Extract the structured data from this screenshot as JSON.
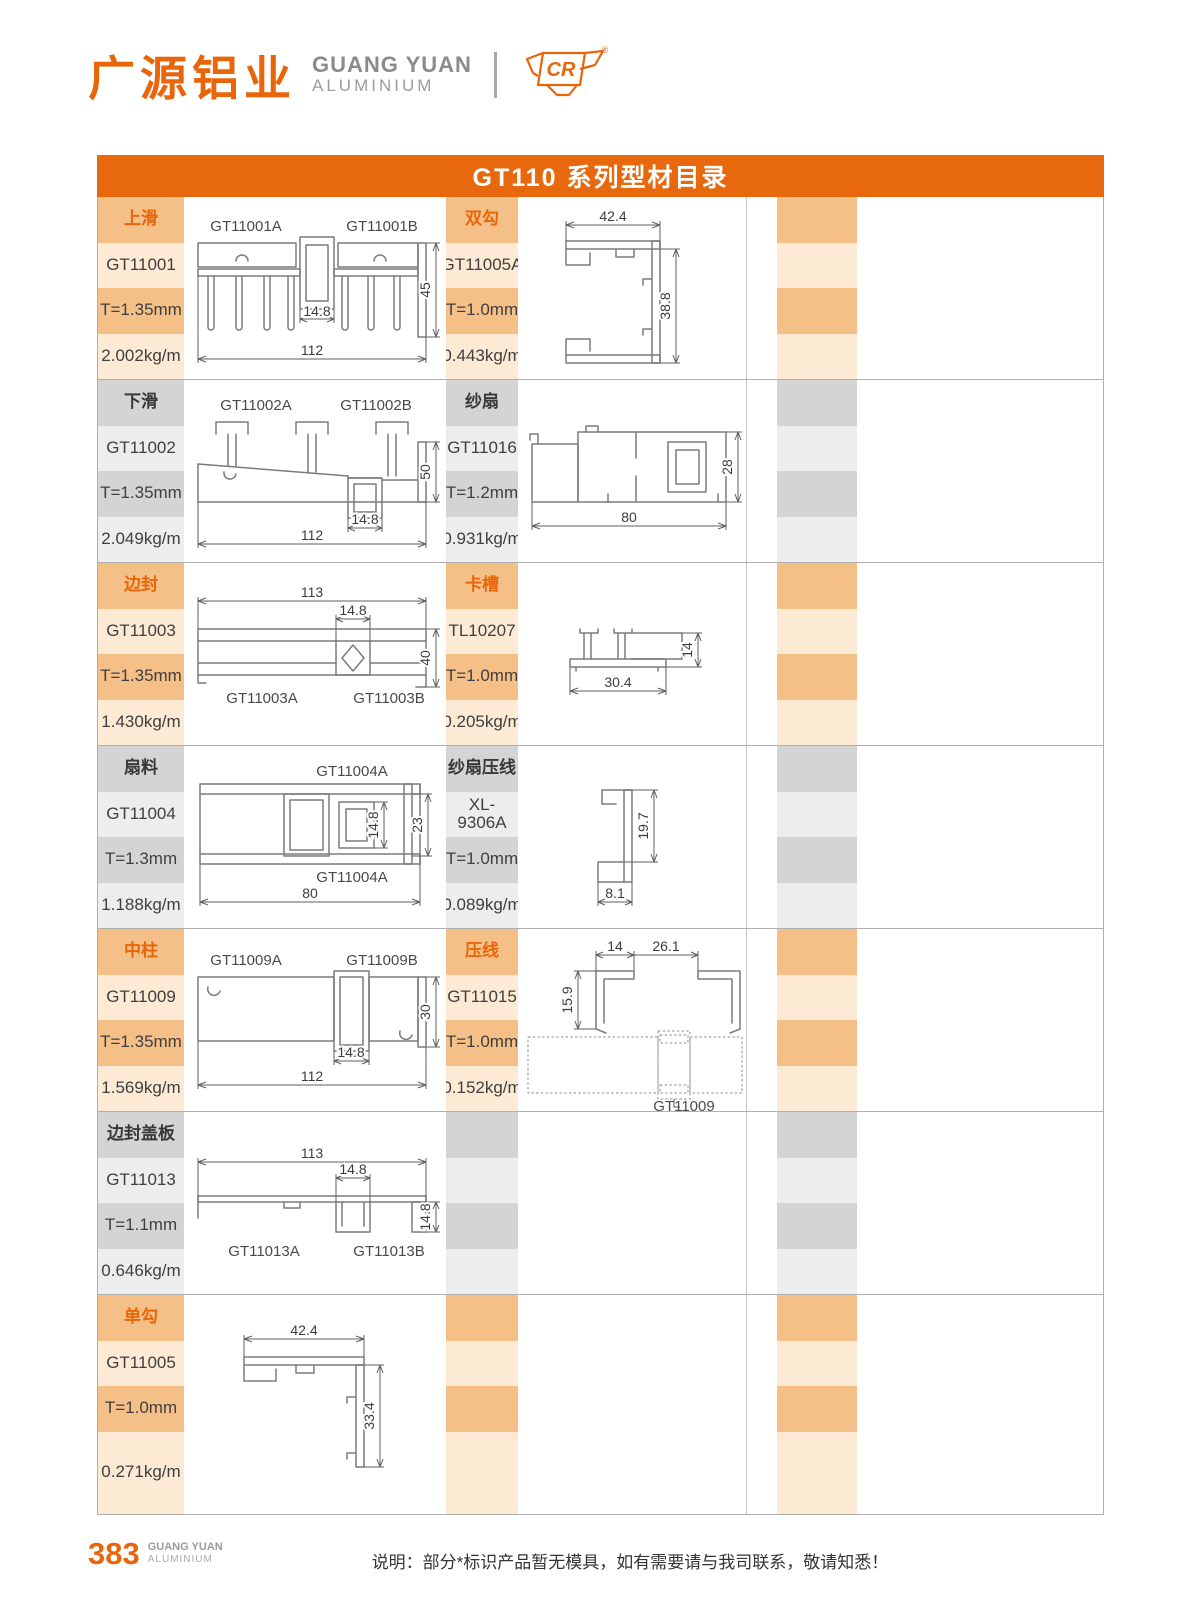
{
  "header": {
    "logo_cn": "广源铝业",
    "logo_en_line1": "GUANG YUAN",
    "logo_en_line2": "ALUMINIUM",
    "cr_mark": "CR",
    "registered": "®"
  },
  "title_bar": "GT110 系列型材目录",
  "colors": {
    "accent_orange": "#E8650A",
    "titlebar_orange": "#E8690D",
    "band_orange": "#F4C088",
    "band_orange_light": "#FCEAD4",
    "band_gray": "#D4D4D4",
    "band_gray_light": "#EDEDED"
  },
  "rows": [
    {
      "theme": "orange",
      "p1": {
        "category": "上滑",
        "code": "GT11001",
        "thickness": "T=1.35mm",
        "weight": "2.002kg/m",
        "label_a": "GT11001A",
        "label_b": "GT11001B",
        "dim_mid": "14.8",
        "dim_height": "45",
        "dim_width": "112"
      },
      "p2": {
        "category": "双勾",
        "code": "GT11005A",
        "thickness": "T=1.0mm",
        "weight": "0.443kg/m",
        "dim_width": "42.4",
        "dim_height": "38.8"
      }
    },
    {
      "theme": "gray",
      "p1": {
        "category": "下滑",
        "code": "GT11002",
        "thickness": "T=1.35mm",
        "weight": "2.049kg/m",
        "label_a": "GT11002A",
        "label_b": "GT11002B",
        "dim_mid": "14.8",
        "dim_height": "50",
        "dim_width": "112"
      },
      "p2": {
        "category": "纱扇",
        "code": "GT11016",
        "thickness": "T=1.2mm",
        "weight": "0.931kg/m",
        "dim_width": "80",
        "dim_height": "28"
      }
    },
    {
      "theme": "orange",
      "p1": {
        "category": "边封",
        "code": "GT11003",
        "thickness": "T=1.35mm",
        "weight": "1.430kg/m",
        "label_a": "GT11003A",
        "label_b": "GT11003B",
        "dim_mid": "14.8",
        "dim_height": "40",
        "dim_width": "113"
      },
      "p2": {
        "category": "卡槽",
        "code": "TL10207",
        "thickness": "T=1.0mm",
        "weight": "0.205kg/m",
        "dim_width": "30.4",
        "dim_height": "14"
      }
    },
    {
      "theme": "gray",
      "p1": {
        "category": "扇料",
        "code": "GT11004",
        "thickness": "T=1.3mm",
        "weight": "1.188kg/m",
        "label_a": "GT11004A",
        "label_b": "GT11004A",
        "dim_mid": "14.8",
        "dim_height": "23",
        "dim_width": "80"
      },
      "p2": {
        "category": "纱扇压线",
        "code": "XL-9306A",
        "thickness": "T=1.0mm",
        "weight": "0.089kg/m",
        "dim_width": "8.1",
        "dim_height": "19.7"
      }
    },
    {
      "theme": "orange",
      "p1": {
        "category": "中柱",
        "code": "GT11009",
        "thickness": "T=1.35mm",
        "weight": "1.569kg/m",
        "label_a": "GT11009A",
        "label_b": "GT11009B",
        "dim_mid": "14.8",
        "dim_height": "30",
        "dim_width": "112"
      },
      "p2": {
        "category": "压线",
        "code": "GT11015",
        "thickness": "T=1.0mm",
        "weight": "0.152kg/m",
        "dim_a": "14",
        "dim_b": "26.1",
        "dim_c": "15.9",
        "ref_label": "GT11009"
      }
    },
    {
      "theme": "gray",
      "p1": {
        "category": "边封盖板",
        "code": "GT11013",
        "thickness": "T=1.1mm",
        "weight": "0.646kg/m",
        "label_a": "GT11013A",
        "label_b": "GT11013B",
        "dim_mid": "14.8",
        "dim_height": "14.8",
        "dim_width": "113"
      },
      "p2": null
    },
    {
      "theme": "orange",
      "p1": {
        "category": "单勾",
        "code": "GT11005",
        "thickness": "T=1.0mm",
        "weight": "0.271kg/m",
        "dim_width": "42.4",
        "dim_height": "33.4"
      },
      "p2": null
    }
  ],
  "footer": {
    "page_number": "383",
    "brand_line1": "GUANG YUAN",
    "brand_line2": "ALUMINIUM",
    "note": "说明：部分*标识产品暂无模具，如有需要请与我司联系，敬请知悉！"
  }
}
